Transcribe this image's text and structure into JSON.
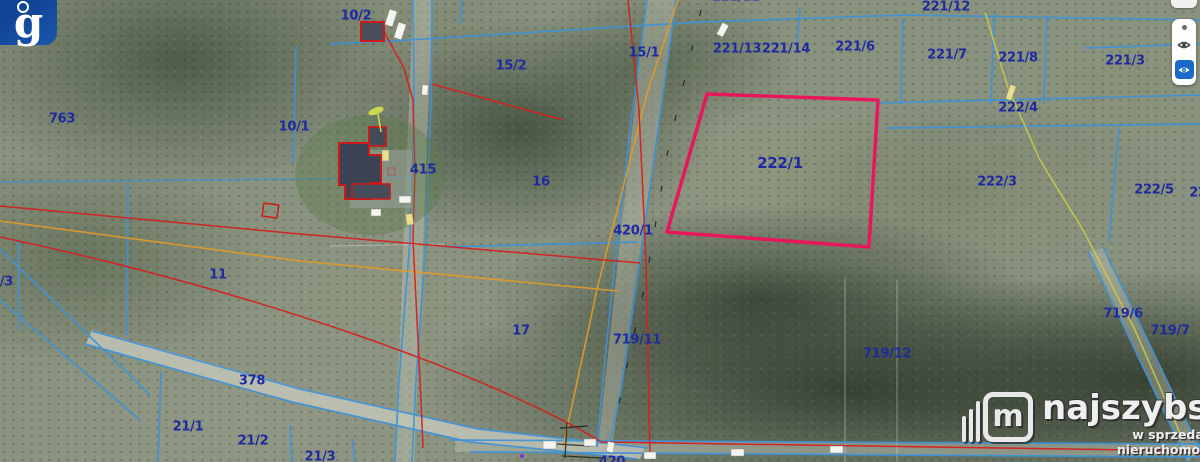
{
  "map": {
    "highlighted_parcel": "222/1",
    "labels": [
      {
        "text": "763",
        "x": 62,
        "y": 119
      },
      {
        "text": "10/2",
        "x": 356,
        "y": 16
      },
      {
        "text": "10/1",
        "x": 294,
        "y": 127
      },
      {
        "text": "15/2",
        "x": 511,
        "y": 66
      },
      {
        "text": "15/1",
        "x": 644,
        "y": 53
      },
      {
        "text": "221/13",
        "x": 737,
        "y": 49
      },
      {
        "text": "221/14",
        "x": 786,
        "y": 49
      },
      {
        "text": "221/6",
        "x": 855,
        "y": 47
      },
      {
        "text": "221/11",
        "x": 736,
        "y": -3
      },
      {
        "text": "221/12",
        "x": 946,
        "y": 7
      },
      {
        "text": "221/7",
        "x": 947,
        "y": 55
      },
      {
        "text": "221/8",
        "x": 1018,
        "y": 58
      },
      {
        "text": "221/3",
        "x": 1125,
        "y": 61
      },
      {
        "text": "222/4",
        "x": 1018,
        "y": 108
      },
      {
        "text": "222/1",
        "x": 780,
        "y": 163,
        "size": 15
      },
      {
        "text": "415",
        "x": 423,
        "y": 170
      },
      {
        "text": "16",
        "x": 541,
        "y": 182
      },
      {
        "text": "222/3",
        "x": 997,
        "y": 182
      },
      {
        "text": "222/5",
        "x": 1154,
        "y": 190
      },
      {
        "text": "222/2",
        "x": 1209,
        "y": 193
      },
      {
        "text": "420/1",
        "x": 633,
        "y": 231
      },
      {
        "text": "4/3",
        "x": 2,
        "y": 282
      },
      {
        "text": "11",
        "x": 218,
        "y": 275
      },
      {
        "text": "17",
        "x": 521,
        "y": 331
      },
      {
        "text": "719/11",
        "x": 637,
        "y": 340
      },
      {
        "text": "719/6",
        "x": 1123,
        "y": 314
      },
      {
        "text": "719/7",
        "x": 1170,
        "y": 331
      },
      {
        "text": "719/12",
        "x": 887,
        "y": 354
      },
      {
        "text": "378",
        "x": 252,
        "y": 381
      },
      {
        "text": "21/1",
        "x": 188,
        "y": 427
      },
      {
        "text": "21/2",
        "x": 253,
        "y": 441
      },
      {
        "text": "21/3",
        "x": 320,
        "y": 457
      },
      {
        "text": "420",
        "x": 612,
        "y": 462
      }
    ],
    "colors": {
      "highlight_pink": "#e8175d",
      "boundary_blue": "#3f92d8",
      "label_navy": "#1f2a9e",
      "road_orange": "#e09a28",
      "survey_red": "#d42020",
      "path_yellow": "#c9cc4a"
    }
  },
  "geoportal_logo": {
    "glyph": "g"
  },
  "layer_panel": {
    "buttons": [
      {
        "icon": "dot-icon"
      },
      {
        "icon": "eye-icon"
      },
      {
        "icon": "eye-filled-icon",
        "active": true,
        "color": "#1a6bc8"
      }
    ]
  },
  "watermark": {
    "logo_letter": "m",
    "brand": "najszybsi",
    "tagline": "w sprzedaży nieruchomości"
  }
}
